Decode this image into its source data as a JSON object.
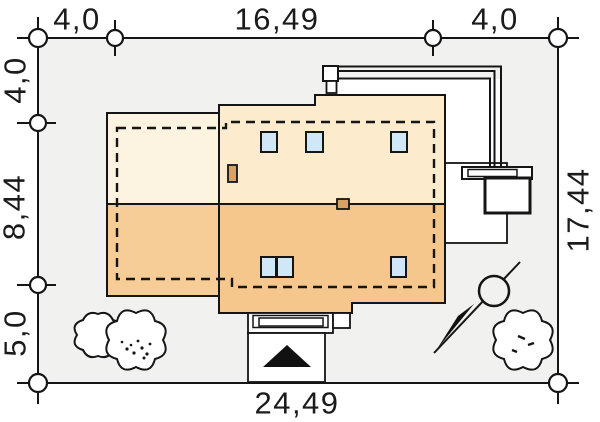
{
  "plan": {
    "type": "house-site-plan",
    "dims": {
      "top_left": "4,0",
      "top_center": "16,49",
      "top_right": "4,0",
      "left_top": "4,0",
      "left_middle": "8,44",
      "left_bottom": "5,0",
      "right_side": "17,44",
      "bottom_center": "24,49"
    },
    "symbols": [
      "north-arrow",
      "tree",
      "survey-point",
      "entrance-arrow"
    ]
  },
  "colors": {
    "plot_fill": "#f1f1f0",
    "roof_upper_wing": "#fdf3e1",
    "roof_upper_main": "#fcebcc",
    "roof_lower_wing": "#f7cd97",
    "roof_lower_main": "#f5c78d",
    "window_fill": "#cfe7f7",
    "chimney_fill": "#d9a167",
    "line": "#151515",
    "white": "#ffffff",
    "arrow_black": "#111111"
  }
}
